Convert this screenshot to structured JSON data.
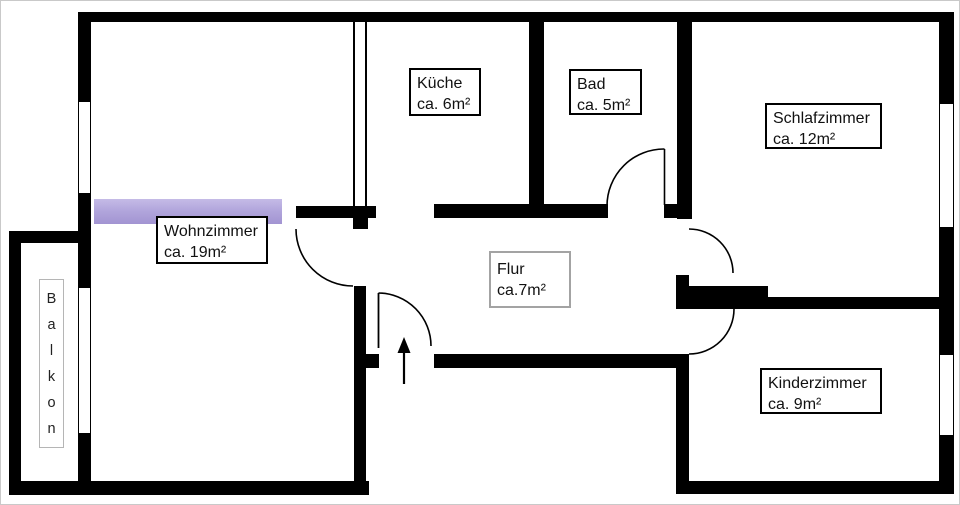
{
  "rooms": {
    "wohnzimmer": {
      "name": "Wohnzimmer",
      "area": "ca. 19m²"
    },
    "kueche": {
      "name": "Küche",
      "area": "ca. 6m²"
    },
    "bad": {
      "name": "Bad",
      "area": "ca. 5m²"
    },
    "schlafzimmer": {
      "name": "Schlafzimmer",
      "area": "ca. 12m²"
    },
    "flur": {
      "name": "Flur",
      "area": "ca.7m²"
    },
    "kinderzimmer": {
      "name": "Kinderzimmer",
      "area": "ca. 9m²"
    },
    "balkon": {
      "name": "Balkon"
    }
  },
  "colors": {
    "wall": "#000000",
    "highlight_bar": "#b2a6dc",
    "flur_label_border": "#a3a3a3",
    "balkon_label_border": "#b5b5b5"
  }
}
